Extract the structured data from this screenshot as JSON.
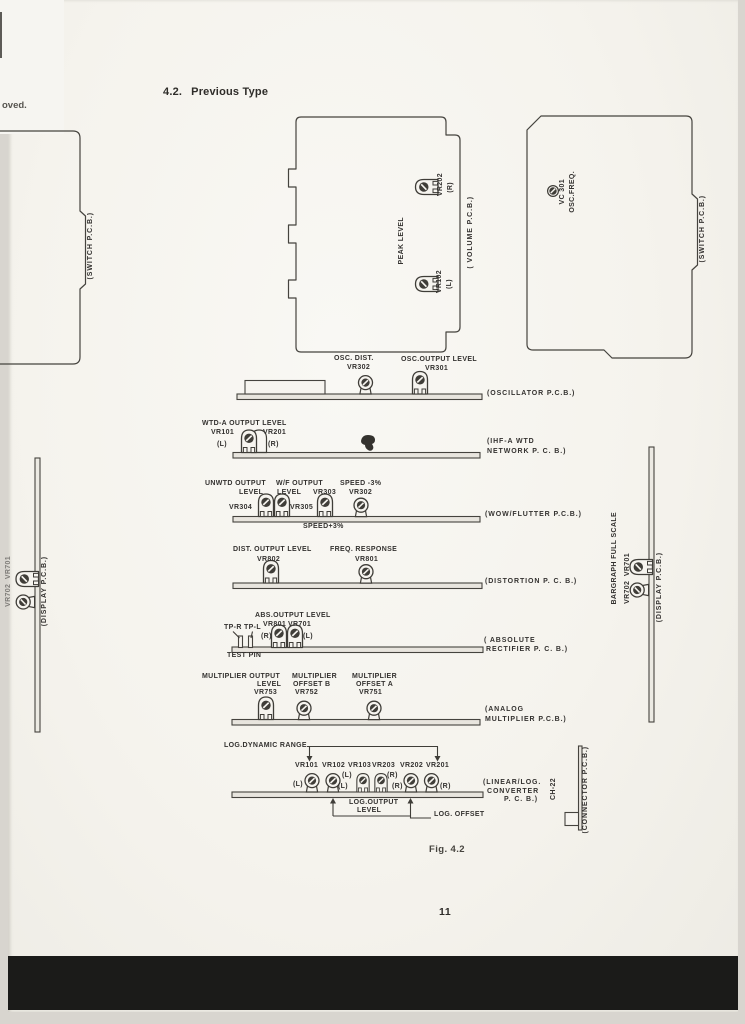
{
  "page": {
    "section": "4.2.",
    "section_title": "Previous Type",
    "figure_caption": "Fig. 4.2",
    "page_number": "11",
    "edge_fragment": "oved."
  },
  "colors": {
    "ink": "#3f3d38",
    "paper": "#f6f4ef",
    "scan_bar": "#1b1b19"
  },
  "boards": {
    "switch_left": {
      "name": "(SWITCH P.C.B.)"
    },
    "volume": {
      "name": "( VOLUME P.C.B.)",
      "silkscreen": "PEAK LEVEL",
      "vr202": "VR202",
      "vr202_ch": "(R)",
      "vr102": "VR102",
      "vr102_ch": "(L)"
    },
    "switch_right": {
      "name": "(SWITCH P.C.B.)",
      "vc301": "VC 301",
      "vc301_fn": "OSC.FREQ."
    },
    "oscillator": {
      "name": "(OSCILLATOR P.C.B.)",
      "fn1": "OSC. DIST.",
      "id1": "VR302",
      "fn2": "OSC.OUTPUT LEVEL",
      "id2": "VR301"
    },
    "ihf": {
      "name_l1": "(IHF-A WTD",
      "name_l2": "NETWORK P. C. B.)",
      "heading": "WTD-A OUTPUT LEVEL",
      "id_l": "VR101",
      "ch_l": "(L)",
      "id_r": "VR201",
      "ch_r": "(R)"
    },
    "wow": {
      "name": "(WOW/FLUTTER P.C.B.)",
      "g1_l1": "UNWTD OUTPUT",
      "g1_l2": "LEVEL",
      "g1_id": "VR304",
      "g2_l1": "W/F OUTPUT",
      "g2_l2": "LEVEL",
      "g2_id": "VR305",
      "g3_id": "VR303",
      "g4_l1": "SPEED -3%",
      "g4_id": "VR302",
      "below": "SPEED+3%"
    },
    "distortion": {
      "name": "(DISTORTION P. C. B.)",
      "fn1": "DIST. OUTPUT LEVEL",
      "id1": "VR802",
      "fn2": "FREQ. RESPONSE",
      "id2": "VR801"
    },
    "absolute": {
      "name_l1": "( ABSOLUTE",
      "name_l2": "RECTIFIER P. C. B.)",
      "heading": "ABS.OUTPUT LEVEL",
      "tp": "TP-R TP-L",
      "id1": "VR801",
      "ch1": "(R)",
      "id2": "VR701",
      "ch2": "(L)",
      "below": "TEST PIN"
    },
    "analog": {
      "name_l1": "(ANALOG",
      "name_l2": "MULTIPLIER P.C.B.)",
      "g1_l1": "MULTIPLIER OUTPUT",
      "g1_l2": "LEVEL",
      "g1_id": "VR753",
      "g2_l1": "MULTIPLIER",
      "g2_l2": "OFFSET B",
      "g2_id": "VR752",
      "g3_l1": "MULTIPLIER",
      "g3_l2": "OFFSET A",
      "g3_id": "VR751"
    },
    "linlog": {
      "name_l1": "(LINEAR/LOG.",
      "name_l2": "CONVERTER",
      "name_l3": "P. C. B.)",
      "range": "LOG.DYNAMIC RANGE",
      "ids": [
        "VR101",
        "VR102",
        "VR103",
        "VR203",
        "VR202",
        "VR201"
      ],
      "ch_l": "(L)",
      "ch_r": "(R)",
      "out_l1": "LOG.OUTPUT",
      "out_l2": "LEVEL",
      "offset": "LOG. OFFSET"
    },
    "connector": {
      "id": "CH-22",
      "name": "(CONNECTOR P.C.B.)"
    },
    "display_right": {
      "scale": "BARGRAPH FULL SCALE",
      "ids": "VR702  VR701",
      "name": "(DISPLAY P.C.B.)"
    },
    "display_left": {
      "ids": "VR702  VR701",
      "name": "(DISPLAY P.C.B.)"
    }
  }
}
